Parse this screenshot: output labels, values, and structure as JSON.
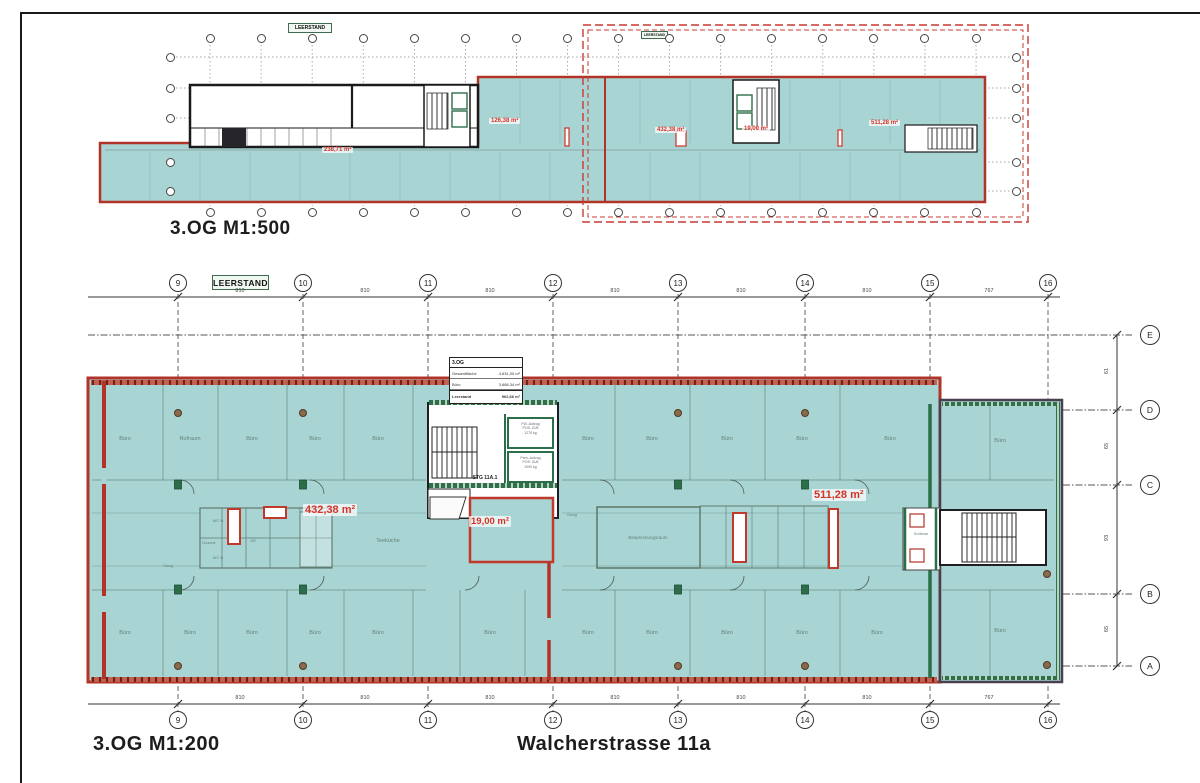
{
  "overview": {
    "title": "3.OG  M1:500",
    "badges": [
      "LEERSTAND",
      "LEERSTAND"
    ],
    "area_labels": [
      "238,71 m²",
      "126,38 m²",
      "432,38 m²",
      "19,00 m²",
      "511,28 m²"
    ]
  },
  "detail": {
    "title": "3.OG  M1:200",
    "address": "Walcherstrasse 11a",
    "badge": "LEERSTAND",
    "grid_columns": [
      "9",
      "10",
      "11",
      "12",
      "13",
      "14",
      "15",
      "16"
    ],
    "grid_rows": [
      "E",
      "D",
      "C",
      "B",
      "A"
    ],
    "dim_top": [
      "810",
      "810",
      "810",
      "810",
      "810",
      "810",
      "767"
    ],
    "dim_bottom": [
      "810",
      "810",
      "810",
      "810",
      "810",
      "810",
      "767"
    ],
    "dim_right": [
      "61",
      "65",
      "93",
      "65"
    ],
    "area_labels": [
      "432,38 m²",
      "19,00 m²",
      "511,28 m²"
    ],
    "stair_label": "STG 11A.1",
    "elevators": [
      {
        "line1": "FW.-Aufzug",
        "line2": "POS. ZU5",
        "line3": "1275 kg"
      },
      {
        "line1": "Pers.-Aufzug",
        "line2": "POS. ZU6",
        "line3": "1000 kg"
      }
    ],
    "info_table": {
      "header": "3.OG",
      "rows": [
        {
          "label": "Gesamtfläche",
          "value": "4.631,00 m²"
        },
        {
          "label": "Büro",
          "value": "3.668,34 m²"
        },
        {
          "label": "Leerstand",
          "value": "962,66 m²"
        }
      ]
    },
    "room_labels": {
      "buero": "Büro",
      "rufraum": "Rufraum",
      "teekueche": "Teeküche",
      "besprechung": "Besprechungsraum",
      "gang": "Gang",
      "dusche": "Dusche",
      "ar": "AR",
      "wch": "WC H",
      "wcd": "WC D",
      "schleuse": "Schleuse"
    },
    "colors": {
      "floor_teal": "#a8d4d3",
      "wall_red": "#b23327",
      "label_red": "#d63227",
      "wall_green": "#2c6e49",
      "extension_dark": "#4a3f4d",
      "highlight_dashed_red": "#cc3932"
    }
  }
}
